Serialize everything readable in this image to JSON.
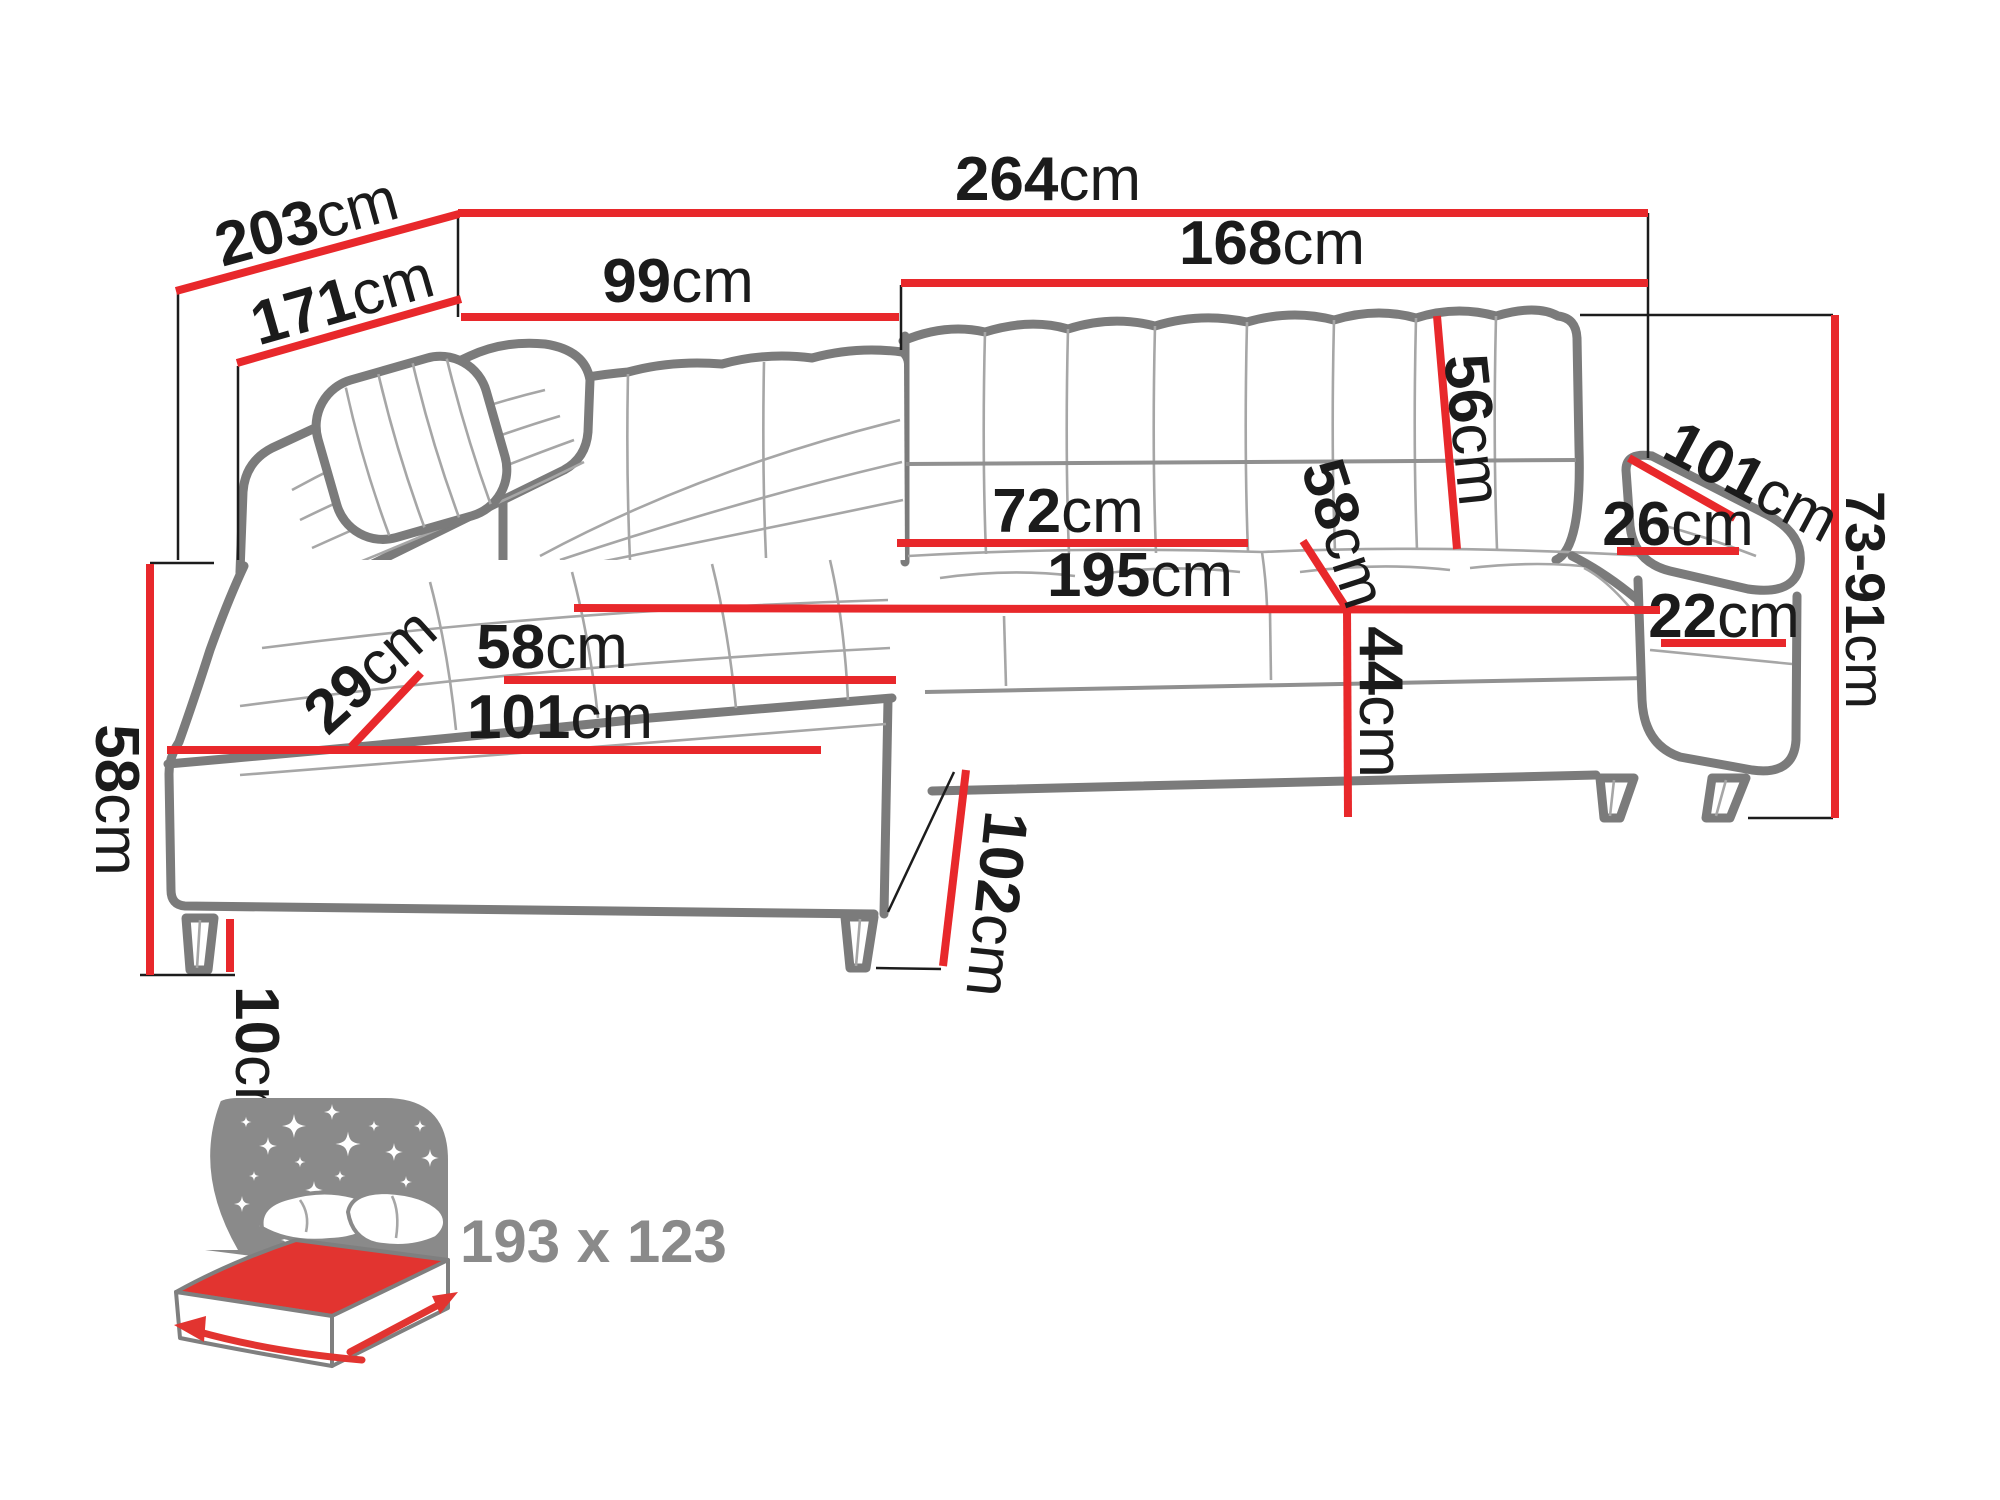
{
  "diagram_title": "corner-sofa-dimension-diagram",
  "colors": {
    "dim-red": "#e8282b",
    "outline": "#7b7b7b",
    "seam": "#a6a6a6",
    "ink": "#1b1b1b",
    "bed-grey": "#8a8a8a",
    "bed-red": "#e23430"
  },
  "dims": {
    "overall_width": {
      "num": "264",
      "unit": "cm"
    },
    "overall_depth": {
      "num": "203",
      "unit": "cm"
    },
    "depth_to_seat": {
      "num": "171",
      "unit": "cm"
    },
    "back_left_width": {
      "num": "99",
      "unit": "cm"
    },
    "back_right_width": {
      "num": "168",
      "unit": "cm"
    },
    "backrest_height": {
      "num": "56",
      "unit": "cm"
    },
    "back_channel_width": {
      "num": "72",
      "unit": "cm"
    },
    "seat_length": {
      "num": "195",
      "unit": "cm"
    },
    "seat_depth": {
      "num": "58",
      "unit": "cm"
    },
    "seat_height": {
      "num": "44",
      "unit": "cm"
    },
    "armrest_length": {
      "num": "101",
      "unit": "cm"
    },
    "armrest_width": {
      "num": "26",
      "unit": "cm"
    },
    "armrest_height": {
      "num": "22",
      "unit": "cm"
    },
    "total_height": {
      "num": "73-91",
      "unit": "cm"
    },
    "chaise_corner_depth": {
      "num": "29",
      "unit": "cm"
    },
    "chaise_seat_width": {
      "num": "58",
      "unit": "cm"
    },
    "chaise_seat_length": {
      "num": "101",
      "unit": "cm"
    },
    "side_height": {
      "num": "58",
      "unit": "cm"
    },
    "leg_height": {
      "num": "10",
      "unit": "cm"
    },
    "chaise_front_length": {
      "num": "102",
      "unit": "cm"
    }
  },
  "sleeping_area": {
    "label": "193 x 123"
  }
}
